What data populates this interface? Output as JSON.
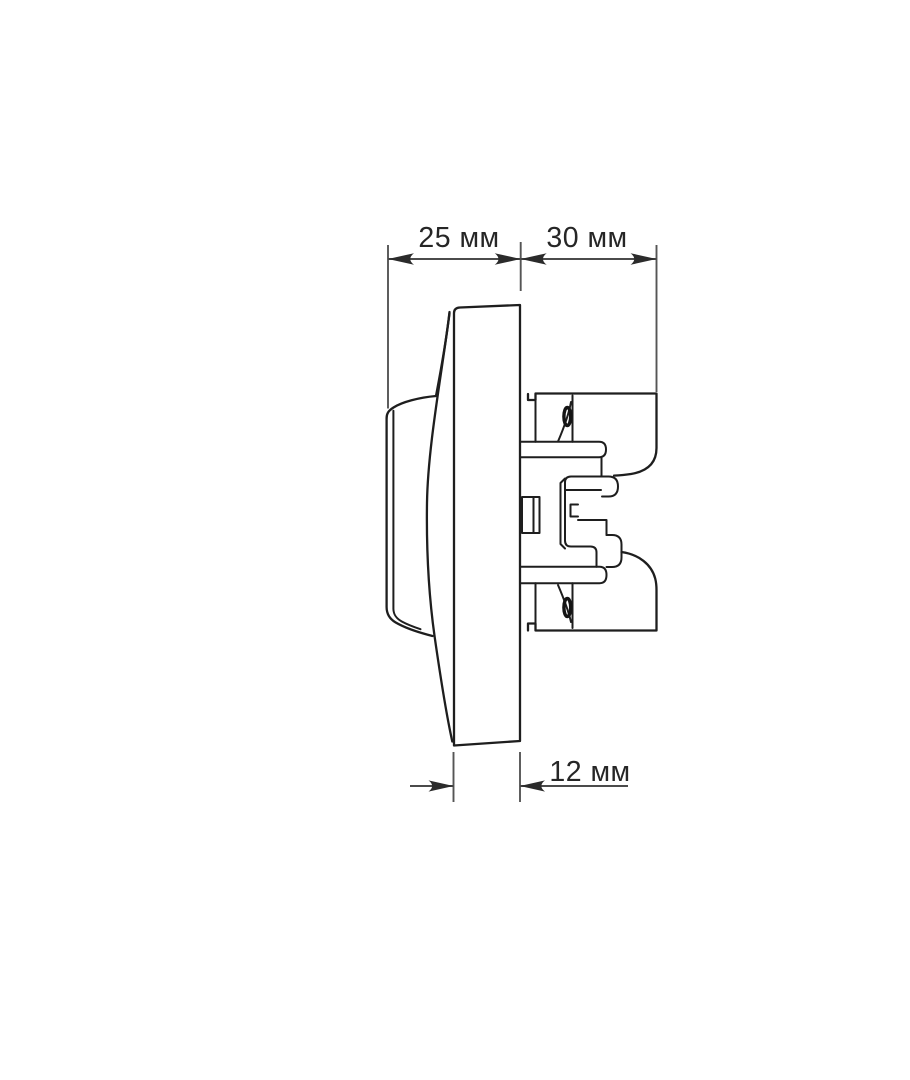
{
  "canvas": {
    "width": 910,
    "height": 1080,
    "background": "#ffffff"
  },
  "colors": {
    "drawing_outline": "#1e1e1e",
    "dimension_lines": "#4b4b4b",
    "arrow_fill": "#2b2b2b",
    "label_text": "#262626"
  },
  "diagram": {
    "kind": "technical-dimension-drawing",
    "subject": "wall-switch-side-profile",
    "dimensions": {
      "front_depth": {
        "label": "25 мм",
        "value": 25,
        "unit": "мм"
      },
      "rear_depth": {
        "label": "30 мм",
        "value": 30,
        "unit": "мм"
      },
      "plate_thickness": {
        "label": "12 мм",
        "value": 12,
        "unit": "мм"
      }
    }
  }
}
